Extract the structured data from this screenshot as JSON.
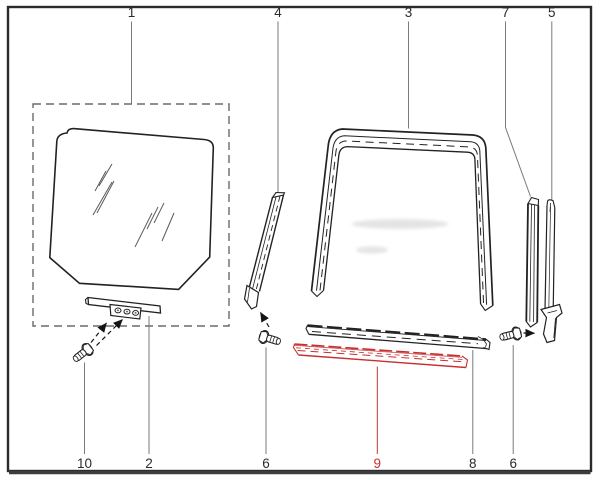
{
  "colors": {
    "background": "#ffffff",
    "border": "#2b2b2b",
    "line_art": "#222222",
    "leader_line": "#7a7a7a",
    "dashed_box": "#6a6a6a",
    "highlight_red": "#c63030"
  },
  "callouts": {
    "top": [
      {
        "label": "1"
      },
      {
        "label": "4"
      },
      {
        "label": "3"
      },
      {
        "label": "7"
      },
      {
        "label": "5"
      }
    ],
    "bottom": [
      {
        "label": "10"
      },
      {
        "label": "2"
      },
      {
        "label": "6"
      },
      {
        "label": "9",
        "highlighted": true
      },
      {
        "label": "8"
      },
      {
        "label": "6"
      }
    ],
    "highlighted_label": "9"
  }
}
